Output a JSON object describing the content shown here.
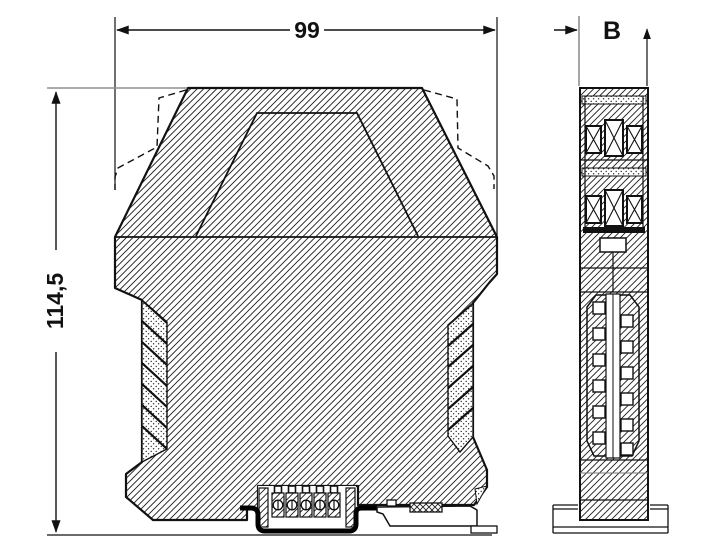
{
  "drawing": {
    "type": "technical-dimension-drawing",
    "views": [
      "front",
      "side"
    ],
    "dimensions": {
      "width": {
        "label": "99"
      },
      "height": {
        "label": "114,5"
      },
      "depth": {
        "label": "B"
      }
    },
    "colors": {
      "line": "#111111",
      "extension_line": "#8f8f8f",
      "background": "#ffffff"
    }
  }
}
